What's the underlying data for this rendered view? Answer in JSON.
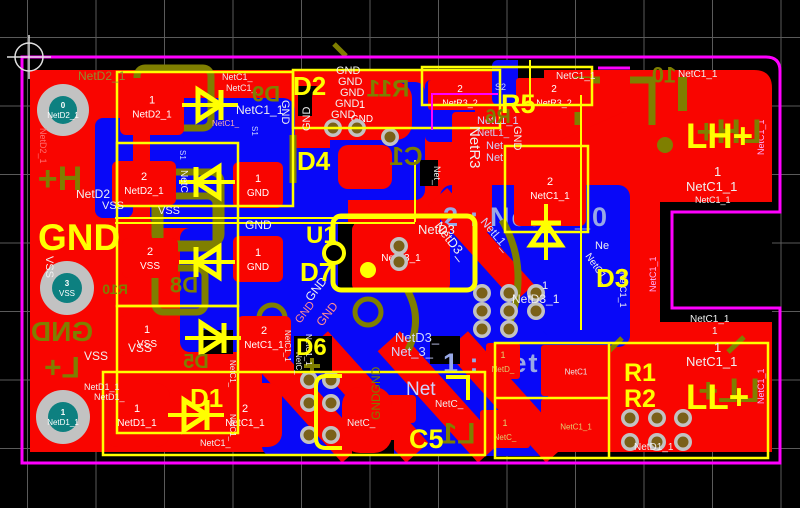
{
  "title": "PCB layout editor canvas",
  "colors": {
    "background": "#000000",
    "grid": "#5a5a5a",
    "board_outline": "#ff00ff",
    "copper_top": "#f90500",
    "copper_bottom": "#0808f8",
    "silk_top": "#ffff00",
    "silk_bottom": "#7f7f00",
    "pad_ring": "#c2c2c2",
    "plated_hole": "#0d8080",
    "via_center": "#7a6018",
    "net_label": "#f0f0f0",
    "net_label_dim": "#ff9090",
    "net_label_blue": "#cfd6ff",
    "highlight_text": "#98a8e6",
    "pad_label_gold": "#e0d070"
  },
  "highlights": {
    "h1": {
      "text": "2 : NetL1_0"
    },
    "h2": {
      "text": "1 : Net"
    }
  },
  "big_labels": {
    "gnd": "GND",
    "lh": "LH+",
    "ll": "LL+"
  },
  "designators_top": [
    {
      "t": "D2",
      "x": 293,
      "y": 95,
      "s": 26
    },
    {
      "t": "D4",
      "x": 297,
      "y": 170,
      "s": 26
    },
    {
      "t": "R5",
      "x": 501,
      "y": 113,
      "s": 27
    },
    {
      "t": "U1",
      "x": 306,
      "y": 243,
      "s": 24
    },
    {
      "t": "D7",
      "x": 300,
      "y": 281,
      "s": 26
    },
    {
      "t": "D3",
      "x": 596,
      "y": 287,
      "s": 26
    },
    {
      "t": "D6",
      "x": 296,
      "y": 355,
      "s": 24
    },
    {
      "t": "D1",
      "x": 190,
      "y": 407,
      "s": 26
    },
    {
      "t": "R1",
      "x": 624,
      "y": 381,
      "s": 25
    },
    {
      "t": "R2",
      "x": 624,
      "y": 407,
      "s": 25
    },
    {
      "t": "C5",
      "x": 409,
      "y": 448,
      "s": 27
    }
  ],
  "designators_bottom": [
    {
      "t": "D9",
      "x": 266,
      "y": 94,
      "s": 22
    },
    {
      "t": "R11",
      "x": 388,
      "y": 88,
      "s": 24
    },
    {
      "t": "R6",
      "x": 498,
      "y": 116,
      "s": 20
    },
    {
      "t": "C1",
      "x": 406,
      "y": 156,
      "s": 26
    },
    {
      "t": "10",
      "x": 664,
      "y": 75,
      "s": 22
    },
    {
      "t": "D8",
      "x": 184,
      "y": 285,
      "s": 22
    },
    {
      "t": "R10",
      "x": 115,
      "y": 289,
      "s": 14
    },
    {
      "t": "D5",
      "x": 196,
      "y": 361,
      "s": 20
    },
    {
      "t": "L1",
      "x": 458,
      "y": 433,
      "s": 30
    },
    {
      "t": "H+",
      "x": 60,
      "y": 178,
      "s": 34
    },
    {
      "t": "L+",
      "x": 62,
      "y": 367,
      "s": 30
    },
    {
      "t": "GND",
      "x": 62,
      "y": 331,
      "s": 28
    },
    {
      "t": "LL+",
      "x": 729,
      "y": 390,
      "s": 34
    },
    {
      "t": "LH+",
      "x": 729,
      "y": 131,
      "s": 34
    }
  ],
  "net_labels": [
    {
      "t": "NetD2_1",
      "x": 78,
      "y": 80,
      "s": 12,
      "c": "#8f8f2f"
    },
    {
      "t": "NetC1_",
      "x": 222,
      "y": 80,
      "s": 9
    },
    {
      "t": "NetC1_",
      "x": 226,
      "y": 91,
      "s": 9
    },
    {
      "t": "NetC1_1",
      "x": 236,
      "y": 114,
      "s": 12
    },
    {
      "t": "NetC1_",
      "x": 212,
      "y": 126,
      "s": 8,
      "c": "#ffb0b0"
    },
    {
      "t": "NetD2",
      "x": 76,
      "y": 198,
      "s": 12
    },
    {
      "t": "NetD2_1",
      "x": 40,
      "y": 128,
      "s": 9,
      "r": 90,
      "c": "#ff7070"
    },
    {
      "t": "VSS",
      "x": 102,
      "y": 209,
      "s": 11
    },
    {
      "t": "VSS",
      "x": 158,
      "y": 214,
      "s": 11
    },
    {
      "t": "GND",
      "x": 336,
      "y": 74,
      "s": 11
    },
    {
      "t": "GND",
      "x": 338,
      "y": 85,
      "s": 11
    },
    {
      "t": "GND",
      "x": 340,
      "y": 96,
      "s": 11
    },
    {
      "t": "GND",
      "x": 335,
      "y": 107,
      "s": 11
    },
    {
      "t": "GND",
      "x": 331,
      "y": 118,
      "s": 11
    },
    {
      "t": "GND",
      "x": 310,
      "y": 131,
      "s": 11,
      "r": -90
    },
    {
      "t": "GND",
      "x": 282,
      "y": 100,
      "s": 11,
      "r": 90
    },
    {
      "t": "GND",
      "x": 245,
      "y": 229,
      "s": 12
    },
    {
      "t": "S2",
      "x": 495,
      "y": 90,
      "s": 9,
      "c": "#c8d4ff"
    },
    {
      "t": "S1",
      "x": 252,
      "y": 126,
      "s": 8,
      "r": 90,
      "c": "#c8d4ff"
    },
    {
      "t": "S1",
      "x": 180,
      "y": 150,
      "s": 8,
      "r": 90,
      "c": "#c8d4ff"
    },
    {
      "t": "NetC",
      "x": 181,
      "y": 170,
      "s": 10,
      "r": 90
    },
    {
      "t": "NetR3",
      "x": 470,
      "y": 126,
      "s": 15,
      "r": 90
    },
    {
      "t": "NetL1_1",
      "x": 477,
      "y": 124,
      "s": 11,
      "c": "#cfd6ff"
    },
    {
      "t": "NetL1_",
      "x": 477,
      "y": 136,
      "s": 10,
      "c": "#cfd6ff"
    },
    {
      "t": "Net",
      "x": 486,
      "y": 149,
      "s": 11,
      "c": "#cfd6ff"
    },
    {
      "t": "Net",
      "x": 486,
      "y": 161,
      "s": 11,
      "c": "#cfd6ff"
    },
    {
      "t": "NetL1_",
      "x": 480,
      "y": 222,
      "s": 12,
      "r": 50,
      "c": "#cfd6ff"
    },
    {
      "t": "Net_",
      "x": 434,
      "y": 166,
      "s": 9,
      "r": 90
    },
    {
      "t": "GND",
      "x": 514,
      "y": 126,
      "s": 11,
      "r": 90
    },
    {
      "t": "NetC1_1",
      "x": 556,
      "y": 79,
      "s": 10
    },
    {
      "t": "NetC1_1",
      "x": 678,
      "y": 77,
      "s": 10
    },
    {
      "t": "1",
      "x": 714,
      "y": 176,
      "s": 13
    },
    {
      "t": "NetC1_1",
      "x": 686,
      "y": 191,
      "s": 13
    },
    {
      "t": "NetC1_1",
      "x": 695,
      "y": 203,
      "s": 9
    },
    {
      "t": "NetC1_1",
      "x": 656,
      "y": 292,
      "s": 9,
      "r": -90,
      "c": "#ffb0ff"
    },
    {
      "t": "NetC1_1",
      "x": 620,
      "y": 272,
      "s": 9,
      "r": 90
    },
    {
      "t": "NetC1_1",
      "x": 764,
      "y": 155,
      "s": 9,
      "r": -90,
      "c": "#ffb0ff"
    },
    {
      "t": "NetC1_1",
      "x": 690,
      "y": 322,
      "s": 10
    },
    {
      "t": "1",
      "x": 712,
      "y": 334,
      "s": 10
    },
    {
      "t": "1",
      "x": 714,
      "y": 352,
      "s": 13
    },
    {
      "t": "NetC1_1",
      "x": 686,
      "y": 366,
      "s": 13
    },
    {
      "t": "NetC1_1",
      "x": 764,
      "y": 404,
      "s": 9,
      "r": -90,
      "c": "#ffb0ff"
    },
    {
      "t": "NetD1_1",
      "x": 634,
      "y": 450,
      "s": 10
    },
    {
      "t": "NetD3",
      "x": 418,
      "y": 234,
      "s": 13
    },
    {
      "t": "NetD3_",
      "x": 434,
      "y": 226,
      "s": 13,
      "r": 52
    },
    {
      "t": "1",
      "x": 542,
      "y": 289,
      "s": 11
    },
    {
      "t": "NetD3_1",
      "x": 512,
      "y": 303,
      "s": 12
    },
    {
      "t": "Ne",
      "x": 595,
      "y": 249,
      "s": 11
    },
    {
      "t": "NetC1_",
      "x": 585,
      "y": 256,
      "s": 10,
      "r": 55
    },
    {
      "t": "NetD3_",
      "x": 395,
      "y": 342,
      "s": 13,
      "c": "#cfd6ff"
    },
    {
      "t": "Net_3_",
      "x": 391,
      "y": 356,
      "s": 13,
      "c": "#cfd6ff"
    },
    {
      "t": "Net",
      "x": 406,
      "y": 395,
      "s": 19,
      "c": "#cfd6ff"
    },
    {
      "t": "NetC_",
      "x": 435,
      "y": 407,
      "s": 10
    },
    {
      "t": "NetC_",
      "x": 347,
      "y": 426,
      "s": 10
    },
    {
      "t": "GND",
      "x": 311,
      "y": 302,
      "s": 12,
      "r": -52
    },
    {
      "t": "GND",
      "x": 300,
      "y": 324,
      "s": 11,
      "r": -52,
      "c": "#ff9090"
    },
    {
      "t": "GND",
      "x": 322,
      "y": 327,
      "s": 12,
      "r": -52,
      "c": "#ff9090"
    },
    {
      "t": "GNDGND",
      "x": 380,
      "y": 420,
      "s": 12,
      "r": -90,
      "c": "#7f7f00"
    },
    {
      "t": "NetC1_1",
      "x": 285,
      "y": 330,
      "s": 8,
      "r": 90
    },
    {
      "t": "NetC_",
      "x": 296,
      "y": 352,
      "s": 8,
      "r": 90
    },
    {
      "t": "NetC1_1",
      "x": 306,
      "y": 334,
      "s": 8,
      "r": 90
    },
    {
      "t": "NetD1_1",
      "x": 84,
      "y": 390,
      "s": 9
    },
    {
      "t": "NetD1_",
      "x": 94,
      "y": 400,
      "s": 9
    },
    {
      "t": "NetC1_",
      "x": 230,
      "y": 360,
      "s": 8,
      "r": 90
    },
    {
      "t": "NetC1_",
      "x": 230,
      "y": 414,
      "s": 8,
      "r": 90
    },
    {
      "t": "NetC1_",
      "x": 200,
      "y": 446,
      "s": 9
    },
    {
      "t": "VSS",
      "x": 84,
      "y": 360,
      "s": 12
    },
    {
      "t": "VSS",
      "x": 128,
      "y": 352,
      "s": 12
    },
    {
      "t": "VSS",
      "x": 46,
      "y": 256,
      "s": 11,
      "r": 90
    }
  ],
  "pads": [
    {
      "x": 120,
      "y": 78,
      "w": 64,
      "h": 57,
      "rx": 6,
      "num": "1",
      "net": "NetD2_1"
    },
    {
      "x": 112,
      "y": 161,
      "w": 64,
      "h": 44,
      "rx": 6,
      "num": "2",
      "net": "NetD2_1"
    },
    {
      "x": 122,
      "y": 238,
      "w": 56,
      "h": 40,
      "rx": 6,
      "num": "2",
      "net": "VSS"
    },
    {
      "x": 118,
      "y": 316,
      "w": 58,
      "h": 40,
      "rx": 6,
      "num": "1",
      "net": "VSS"
    },
    {
      "x": 104,
      "y": 383,
      "w": 66,
      "h": 64,
      "rx": 14,
      "num": "1",
      "net": "NetD1_1"
    },
    {
      "x": 208,
      "y": 383,
      "w": 74,
      "h": 64,
      "rx": 14,
      "num": "2",
      "net": "NetC1_1"
    },
    {
      "x": 233,
      "y": 162,
      "w": 50,
      "h": 46,
      "rx": 6,
      "num": "1",
      "net": "GND"
    },
    {
      "x": 233,
      "y": 236,
      "w": 50,
      "h": 46,
      "rx": 6,
      "num": "1",
      "net": "GND"
    },
    {
      "x": 237,
      "y": 316,
      "w": 54,
      "h": 42,
      "rx": 6,
      "num": "2",
      "net": "NetC1_1"
    },
    {
      "x": 312,
      "y": 82,
      "w": 100,
      "h": 58,
      "rx": 16,
      "num": "1",
      "net": "GND"
    },
    {
      "x": 428,
      "y": 80,
      "w": 64,
      "h": 30,
      "rx": 3,
      "num": "2",
      "net": "NetR3_2",
      "fs": 9
    },
    {
      "x": 516,
      "y": 78,
      "w": 76,
      "h": 34,
      "rx": 3,
      "num": "2",
      "net": "NetR3_2",
      "fs": 9
    },
    {
      "x": 514,
      "y": 150,
      "w": 72,
      "h": 76,
      "rx": 6,
      "num": "2",
      "net": "NetC1_1"
    },
    {
      "x": 352,
      "y": 222,
      "w": 98,
      "h": 70,
      "rx": 8,
      "net": "NetD3_1"
    },
    {
      "x": 486,
      "y": 343,
      "w": 34,
      "h": 36,
      "rx": 3,
      "num": "1",
      "net": "NetD_",
      "fs": 8,
      "c": "#e0d070"
    },
    {
      "x": 480,
      "y": 410,
      "w": 50,
      "h": 38,
      "rx": 3,
      "num": "1",
      "net": "NetC_",
      "fs": 8,
      "c": "#e0d070"
    },
    {
      "x": 541,
      "y": 345,
      "w": 70,
      "h": 51,
      "rx": 3,
      "net": "NetC1",
      "fs": 8,
      "c": "#e8e8e8"
    },
    {
      "x": 541,
      "y": 399,
      "w": 70,
      "h": 53,
      "rx": 3,
      "net": "NetC1_1",
      "fs": 8,
      "c": "#e0d070"
    },
    {
      "x": 386,
      "y": 395,
      "w": 30,
      "h": 28,
      "rx": 4
    },
    {
      "x": 342,
      "y": 387,
      "w": 50,
      "h": 66,
      "rx": 18
    },
    {
      "x": 338,
      "y": 145,
      "w": 54,
      "h": 44,
      "rx": 10
    }
  ],
  "th_pads": [
    {
      "cx": 63,
      "cy": 110,
      "ring": 26,
      "hole": 14,
      "num": "0",
      "net": "NetD2_1"
    },
    {
      "cx": 67,
      "cy": 288,
      "ring": 27,
      "hole": 15,
      "num": "3",
      "net": "VSS"
    },
    {
      "cx": 63,
      "cy": 417,
      "ring": 27,
      "hole": 15,
      "num": "1",
      "net": "NetD1_1"
    }
  ],
  "vias": {
    "r": 9,
    "points": [
      [
        333,
        128
      ],
      [
        357,
        128
      ],
      [
        390,
        137
      ],
      [
        399,
        246
      ],
      [
        399,
        262
      ],
      [
        482,
        293
      ],
      [
        509,
        293
      ],
      [
        536,
        293
      ],
      [
        482,
        311
      ],
      [
        509,
        311
      ],
      [
        536,
        311
      ],
      [
        482,
        329
      ],
      [
        509,
        329
      ],
      [
        309,
        380
      ],
      [
        331,
        380
      ],
      [
        309,
        403
      ],
      [
        331,
        403
      ],
      [
        309,
        435
      ],
      [
        331,
        435
      ],
      [
        630,
        418
      ],
      [
        657,
        418
      ],
      [
        683,
        418
      ],
      [
        630,
        442
      ],
      [
        657,
        442
      ],
      [
        683,
        442
      ]
    ]
  },
  "diodes": [
    {
      "x": 210,
      "y": 105,
      "d": "right"
    },
    {
      "x": 207,
      "y": 182,
      "d": "left"
    },
    {
      "x": 207,
      "y": 262,
      "d": "left"
    },
    {
      "x": 213,
      "y": 338,
      "d": "right"
    },
    {
      "x": 196,
      "y": 415,
      "d": "right"
    },
    {
      "x": 546,
      "y": 232,
      "d": "up"
    }
  ],
  "ic_u1": {
    "x": 333,
    "y": 216,
    "w": 142,
    "h": 74,
    "notch_cx": 334,
    "notch_cy": 253,
    "dot_cx": 368,
    "dot_cy": 270
  }
}
